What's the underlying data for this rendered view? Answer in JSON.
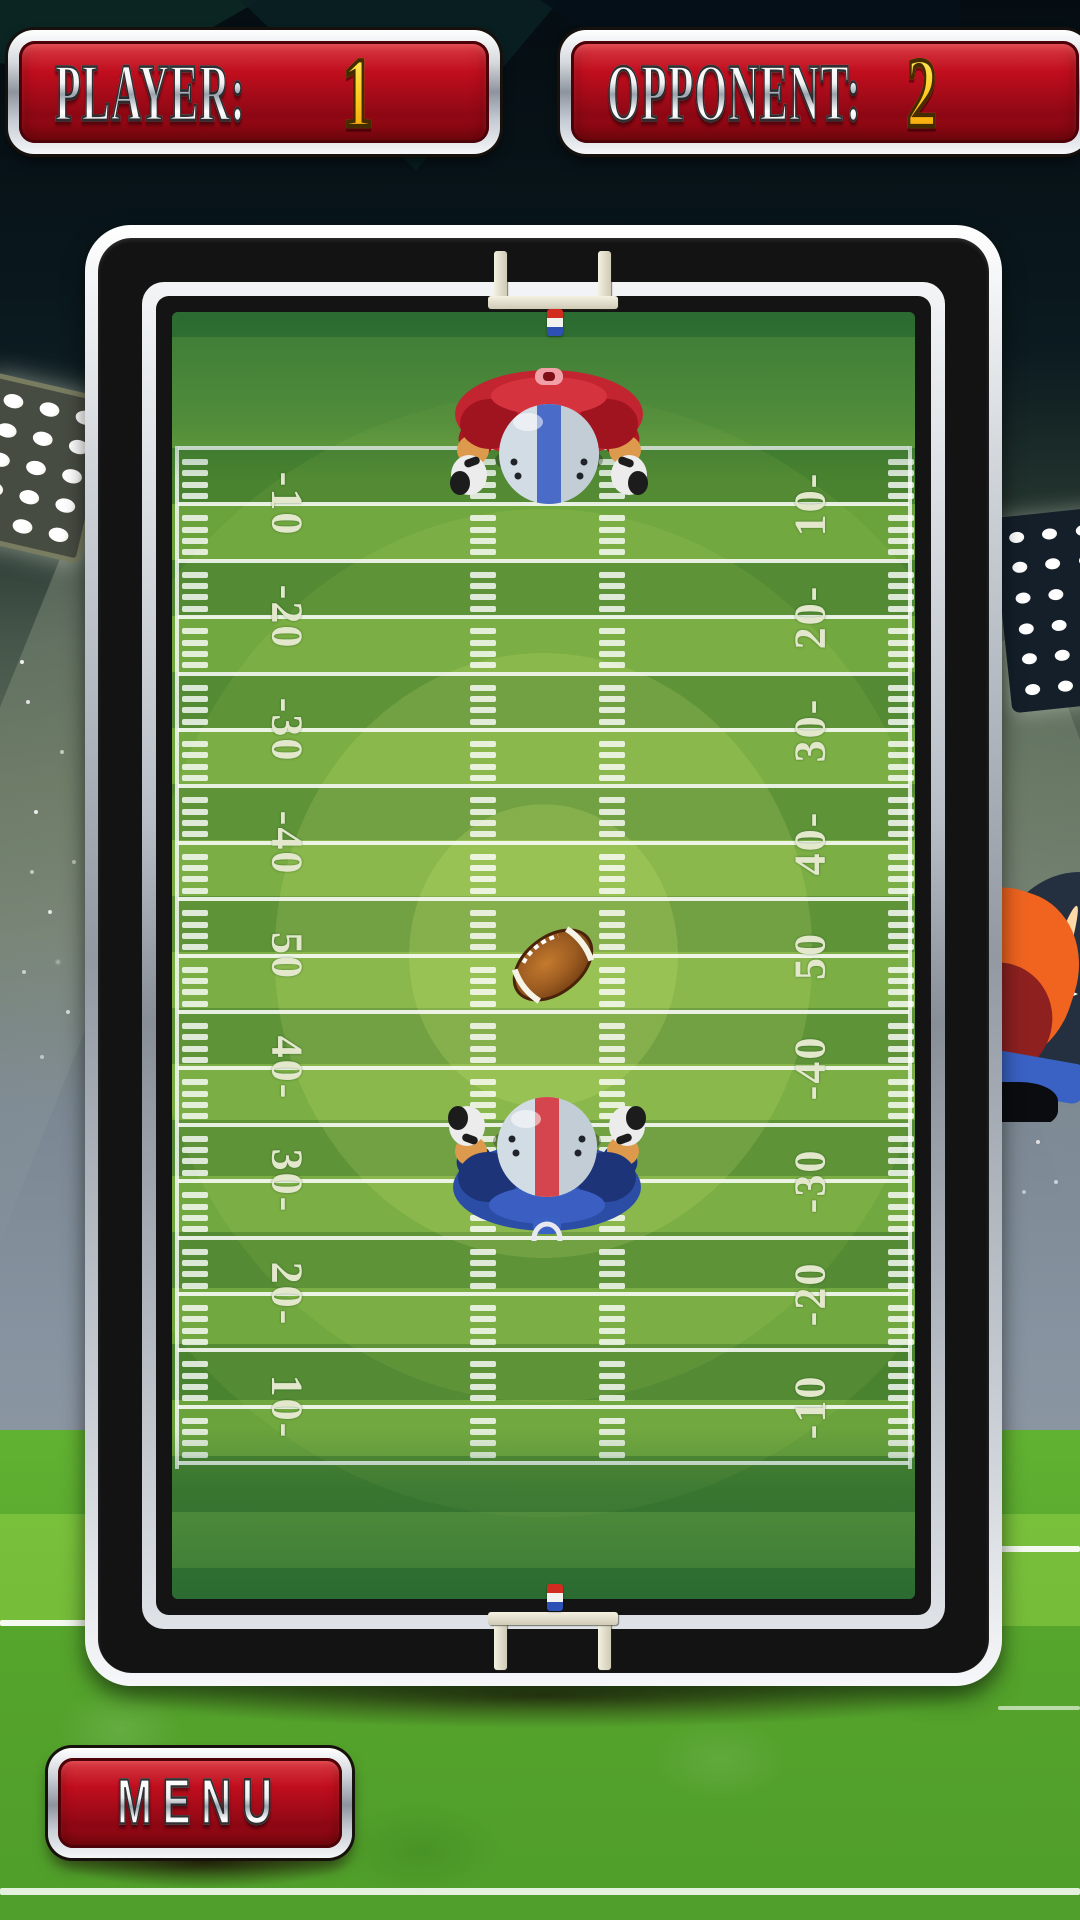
{
  "scoreboard": {
    "player": {
      "label": "PLAYER:",
      "score": "1"
    },
    "opponent": {
      "label": "OPPONENT:",
      "score": "2"
    }
  },
  "menu_button": {
    "label": "MENU"
  },
  "field": {
    "yard_numbers_left": [
      "-10",
      "-20",
      "-30",
      "-40",
      "50",
      "40-",
      "30-",
      "20-",
      "10-"
    ],
    "yard_numbers_right": [
      "10-",
      "20-",
      "30-",
      "40-",
      "50",
      "-40",
      "-30",
      "-20",
      "-10"
    ]
  },
  "colors": {
    "panel_red": "#c10e1e",
    "score_gold": "#ffc81e",
    "chrome": "#c8cdd5",
    "field_stripe_light": "#6aa23c",
    "field_stripe_dark": "#49832f",
    "center_glow": "#dff078",
    "top_player_jersey": "#c22530",
    "bottom_player_jersey": "#2c4da6",
    "helmet": "#d2dce4",
    "top_helmet_stripe": "#4a6cc8",
    "bottom_helmet_stripe": "#d4454e",
    "ball_brown": "#9a5a20",
    "grass": "#55a42c"
  }
}
